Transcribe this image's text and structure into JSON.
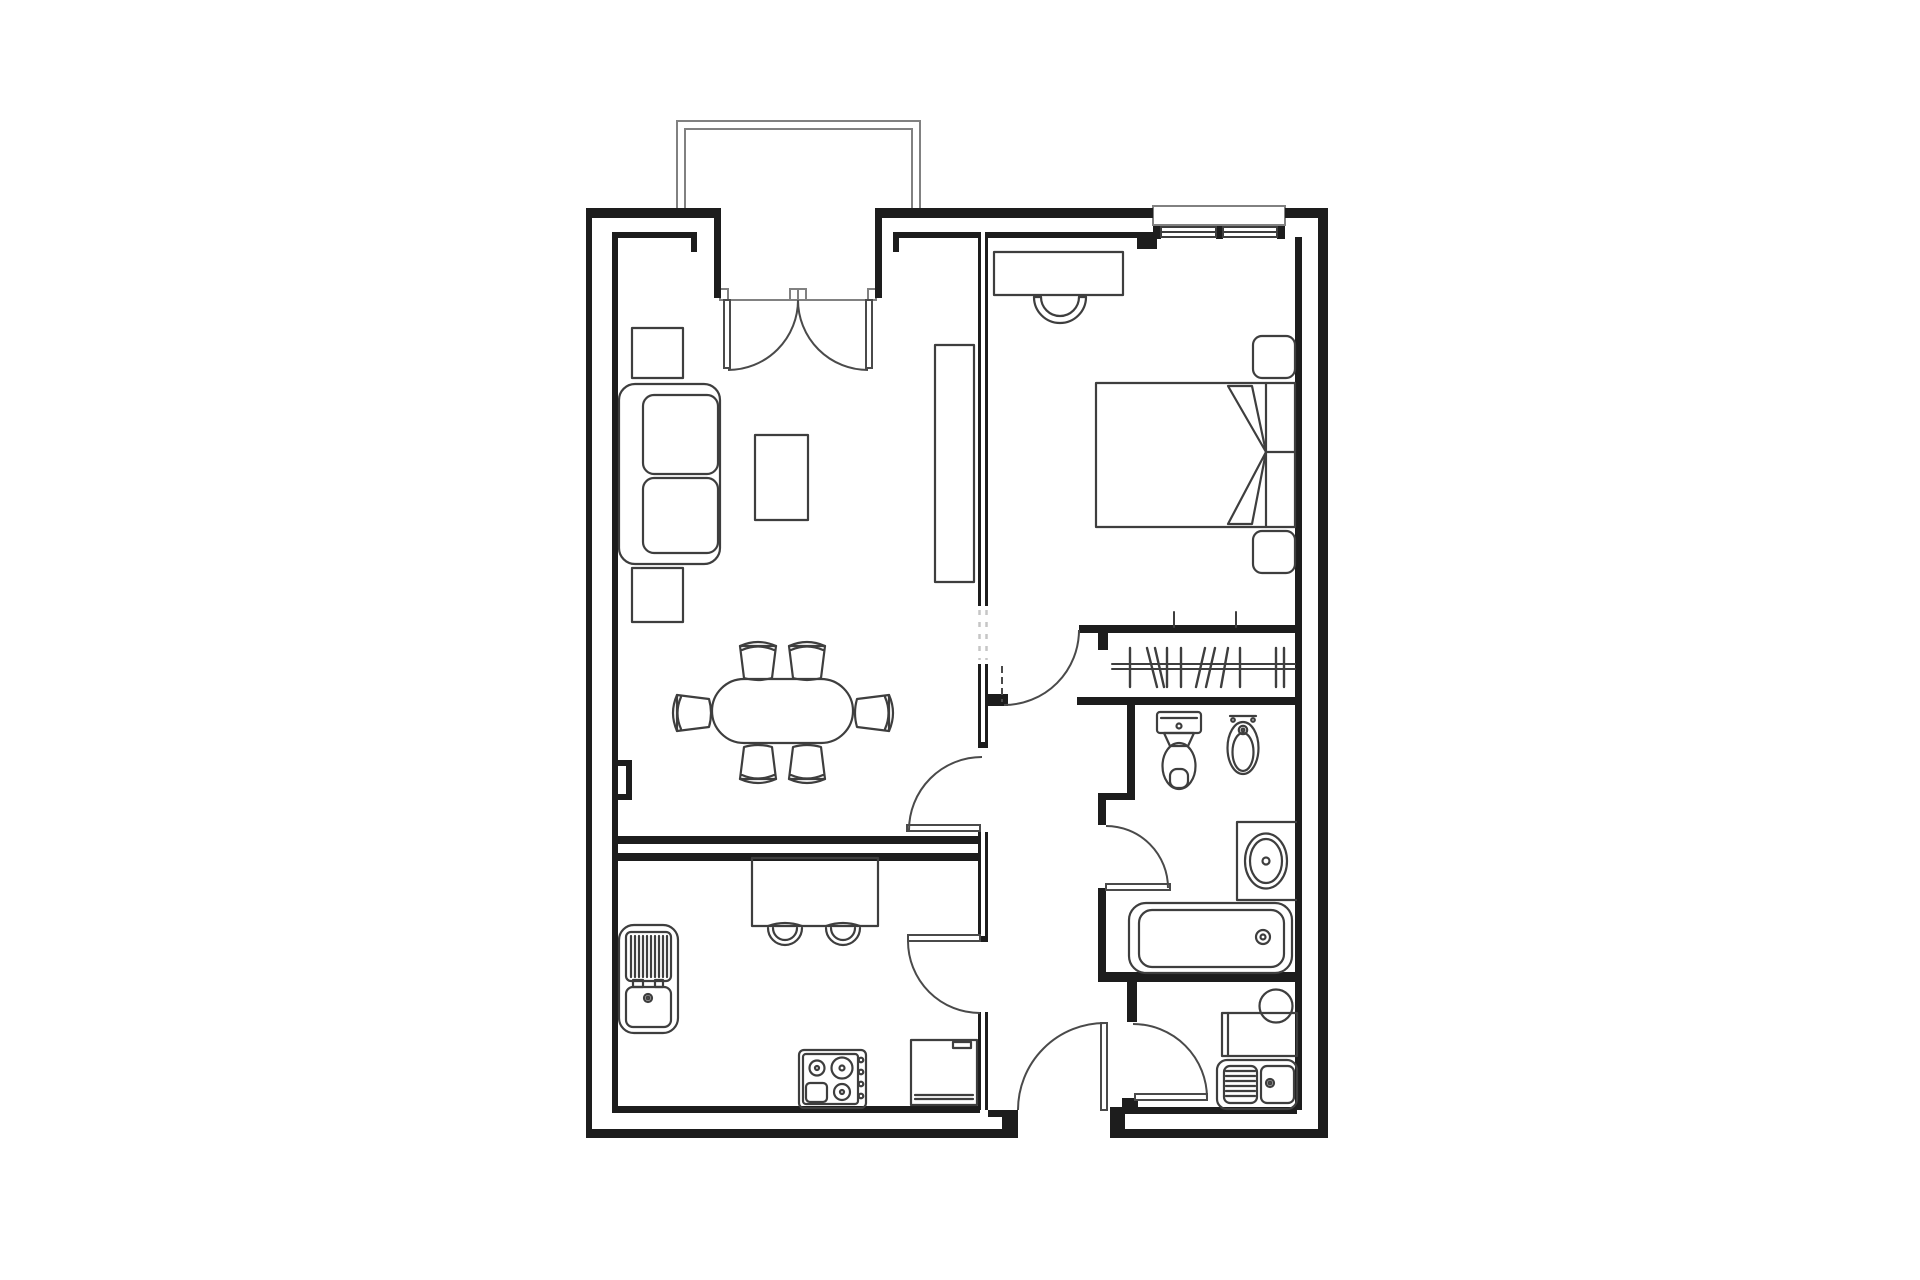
{
  "plan": {
    "background": "#ffffff",
    "colors": {
      "wall": "#1d1d1d",
      "furniture": "#3e3e3e",
      "door": "#4a4a4a",
      "light_detail": "#818181",
      "watermark": "#c6c6c6"
    },
    "drawing_type": "apartment floor plan, top view, black line work on white",
    "areas": [
      "living-dining-room",
      "bedroom",
      "kitchen",
      "hallway",
      "wardrobe-closet",
      "bathroom",
      "laundry-room",
      "balcony"
    ],
    "furniture_symbols": [
      "balcony",
      "double-french-door",
      "window-with-sill",
      "sofa",
      "side-table-top",
      "side-table-bottom",
      "coffee-table",
      "tv-cabinet",
      "oval-dining-table",
      "dining-chair",
      "desk",
      "desk-chair",
      "double-bed",
      "blanket-fold",
      "nightstand",
      "wardrobe-rail-with-hangers",
      "toilet",
      "bidet",
      "vanity-washbasin",
      "bathtub",
      "laundry-basin",
      "laundry-counter",
      "double-laundry-sink",
      "kitchen-sink",
      "kitchen-island",
      "bar-stool",
      "cooktop",
      "refrigerator",
      "door-swing",
      "entrance-door"
    ],
    "counts": {
      "dining_chairs": 6,
      "bar_stools": 2,
      "nightstands": 2,
      "interior_door_swings": 7,
      "rooms_with_fixtures": 4
    }
  }
}
